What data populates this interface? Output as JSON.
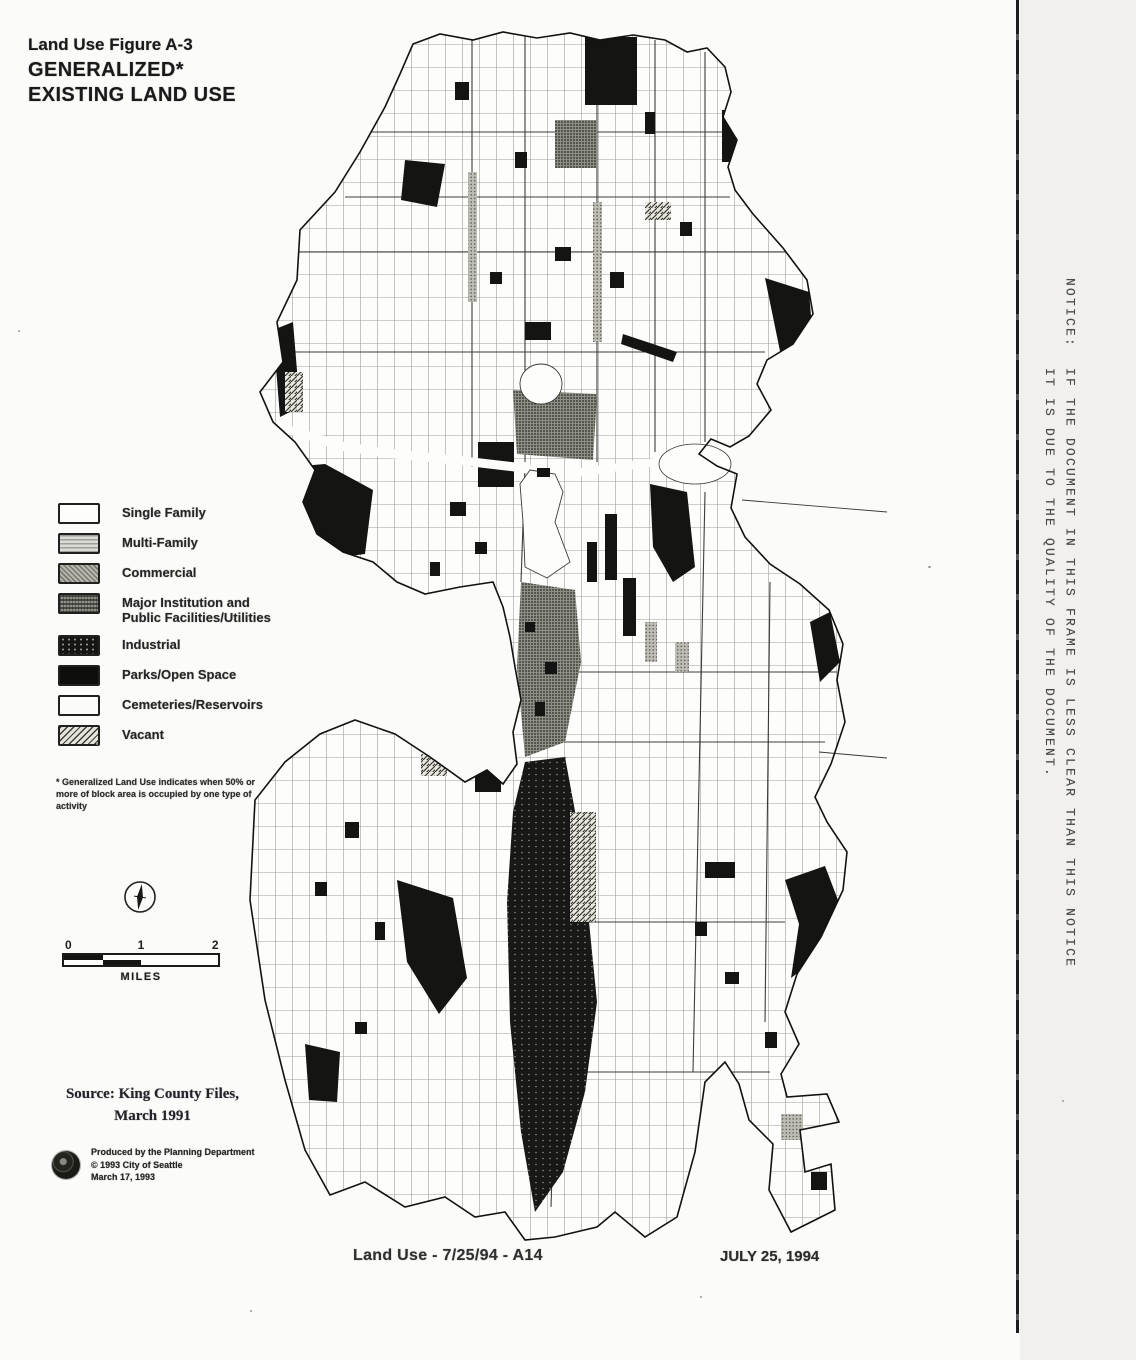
{
  "title": {
    "line1": "Land Use Figure A-3",
    "line2": "GENERALIZED*",
    "line3": "EXISTING LAND USE"
  },
  "legend": {
    "items": [
      {
        "label": "Single Family"
      },
      {
        "label": "Multi-Family"
      },
      {
        "label": "Commercial"
      },
      {
        "label": "Major Institution and Public Facilities/Utilities"
      },
      {
        "label": "Industrial"
      },
      {
        "label": "Parks/Open Space"
      },
      {
        "label": "Cemeteries/Reservoirs"
      },
      {
        "label": "Vacant"
      }
    ],
    "footnote": "* Generalized Land Use indicates when 50% or more of block area is occupied by one type of activity"
  },
  "scale_bar": {
    "tick0": "0",
    "tick1": "1",
    "tick2": "2",
    "unit": "MILES"
  },
  "source": {
    "line1": "Source: King County Files,",
    "line2": "March 1991"
  },
  "credit": {
    "line1": "Produced by the Planning Department",
    "line2": "© 1993 City of Seattle",
    "line3": "March 17, 1993"
  },
  "footer": {
    "left": "Land Use - 7/25/94 - A14",
    "right": "JULY 25, 1994"
  },
  "notice": {
    "line1": "NOTICE:  IF THE DOCUMENT IN THIS FRAME IS LESS CLEAR THAN THIS NOTICE",
    "line2": "         IT IS DUE TO THE QUALITY OF THE DOCUMENT."
  },
  "colors": {
    "ink": "#1a1a1a",
    "paper": "#fbfbf9"
  }
}
